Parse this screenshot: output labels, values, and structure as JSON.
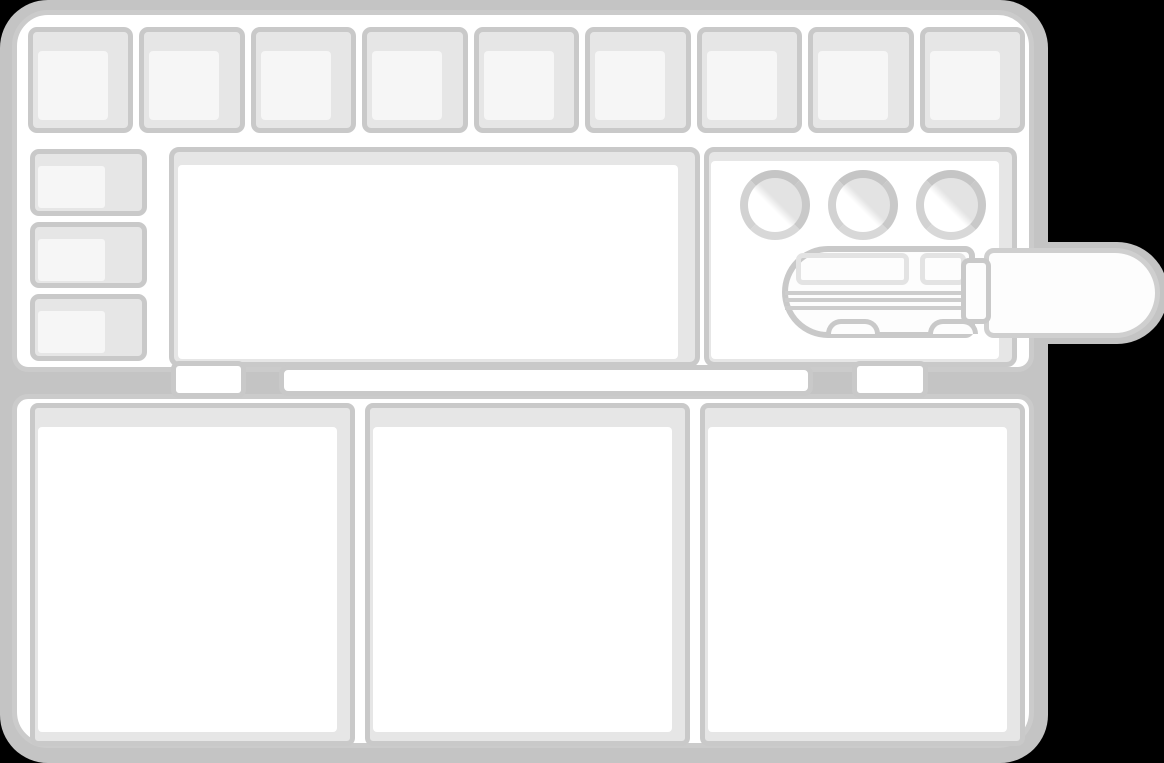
{
  "illustration": {
    "title": "Empty watercolor paint palette, opened, with a paint tube lying across its right edge",
    "style": "hand-drawn grayscale clipart on transparent (black) background",
    "palette_colors": {
      "outline": "#c9c9c9",
      "body_outline": "#cbcbcb",
      "well_fill": "#e6e6e6",
      "surface": "#ffffff",
      "well_bottom": "#f6f6f6",
      "drop_shadow": "#c4c4c4",
      "background": "#000000",
      "tube_surface": "#fdfdfd",
      "label_outline": "#e3e3e3",
      "crimp_line": "#cdcdcd"
    },
    "lid": {
      "paint_well_count": 9,
      "side_well_count": 3,
      "mixing_area_count": 1,
      "round_well_count": 3
    },
    "base": {
      "mixing_well_count": 3
    },
    "hinge": {
      "block_count": 2,
      "bar_count": 1
    },
    "paint_tube": {
      "parts": [
        "body",
        "label-windows",
        "crimp-lines",
        "crimp-bumps",
        "collar",
        "cap"
      ],
      "label_window_count": 2,
      "crimp_line_count": 3,
      "crimp_bump_count": 2
    }
  }
}
